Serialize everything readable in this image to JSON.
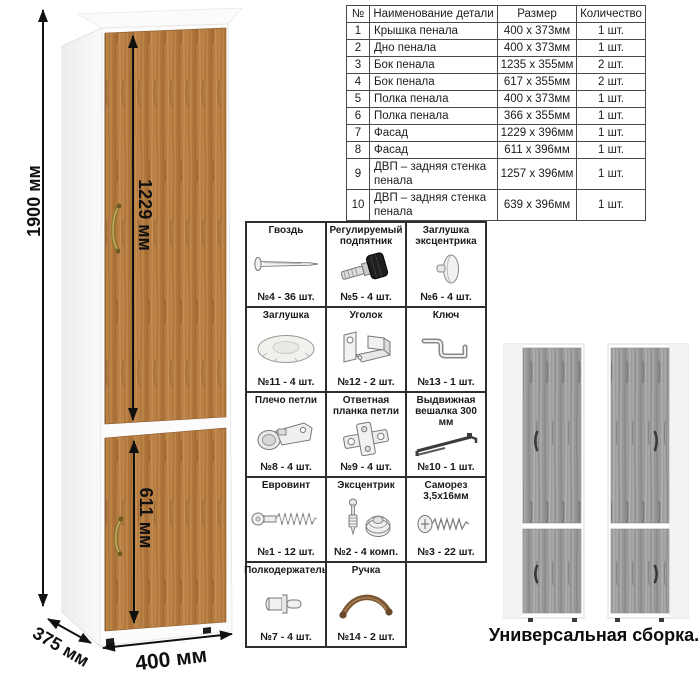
{
  "drawing": {
    "dims": {
      "height": "1900 мм",
      "upper_door": "1229 мм",
      "lower_door": "611 мм",
      "depth": "375 мм",
      "width": "400 мм"
    }
  },
  "parts_table": {
    "headers": [
      "№",
      "Наименование детали",
      "Размер",
      "Количество"
    ],
    "rows": [
      [
        "1",
        "Крышка пенала",
        "400 х 373мм",
        "1 шт."
      ],
      [
        "2",
        "Дно пенала",
        "400 х 373мм",
        "1 шт."
      ],
      [
        "3",
        "Бок пенала",
        "1235 х 355мм",
        "2 шт."
      ],
      [
        "4",
        "Бок пенала",
        "617 х 355мм",
        "2 шт."
      ],
      [
        "5",
        "Полка пенала",
        "400 х 373мм",
        "1 шт."
      ],
      [
        "6",
        "Полка пенала",
        "366 х 355мм",
        "1 шт."
      ],
      [
        "7",
        "Фасад",
        "1229 х 396мм",
        "1 шт."
      ],
      [
        "8",
        "Фасад",
        "611 х 396мм",
        "1 шт."
      ],
      [
        "9",
        "ДВП – задняя стенка пенала",
        "1257 х 396мм",
        "1 шт."
      ],
      [
        "10",
        "ДВП – задняя стенка пенала",
        "639 х 396мм",
        "1 шт."
      ]
    ]
  },
  "hardware": {
    "items": [
      {
        "title": "Гвоздь",
        "count": "№4 - 36 шт.",
        "icon": "nail-icon"
      },
      {
        "title": "Регулируемый подпятник",
        "count": "№5 - 4 шт.",
        "icon": "adjustable-foot-icon"
      },
      {
        "title": "Заглушка эксцентрика",
        "count": "№6 - 4 шт.",
        "icon": "cam-cover-icon"
      },
      {
        "title": "Заглушка",
        "count": "№11 - 4 шт.",
        "icon": "cover-cap-icon"
      },
      {
        "title": "Уголок",
        "count": "№12 - 2 шт.",
        "icon": "angle-bracket-icon"
      },
      {
        "title": "Ключ",
        "count": "№13 - 1 шт.",
        "icon": "hex-key-icon"
      },
      {
        "title": "Плечо петли",
        "count": "№8 - 4 шт.",
        "icon": "hinge-arm-icon"
      },
      {
        "title": "Ответная планка петли",
        "count": "№9 - 4 шт.",
        "icon": "hinge-plate-icon"
      },
      {
        "title": "Выдвижная вешалка 300 мм",
        "count": "№10 - 1 шт.",
        "icon": "pullout-rail-icon"
      },
      {
        "title": "Евровинт",
        "count": "№1 - 12 шт.",
        "icon": "confirmat-screw-icon"
      },
      {
        "title": "Эксцентрик",
        "count": "№2 - 4 комп.",
        "icon": "cam-lock-icon"
      },
      {
        "title": "Саморез 3,5х16мм",
        "count": "№3 - 22 шт.",
        "icon": "self-tapping-screw-icon"
      },
      {
        "title": "Полкодержатель",
        "count": "№7 - 4 шт.",
        "icon": "shelf-pin-icon"
      },
      {
        "title": "Ручка",
        "count": "№14 - 2 шт.",
        "icon": "handle-icon"
      }
    ]
  },
  "variants": {
    "caption": "Универсальная сборка."
  },
  "colors": {
    "wood": "#b67c41",
    "wood_grain_dark": "#8f5f2e",
    "wood_grain_light": "#cf9c5d",
    "gray_wood": "#9c9c9c",
    "handle_bronze": "#8c7534",
    "line": "#101010"
  }
}
